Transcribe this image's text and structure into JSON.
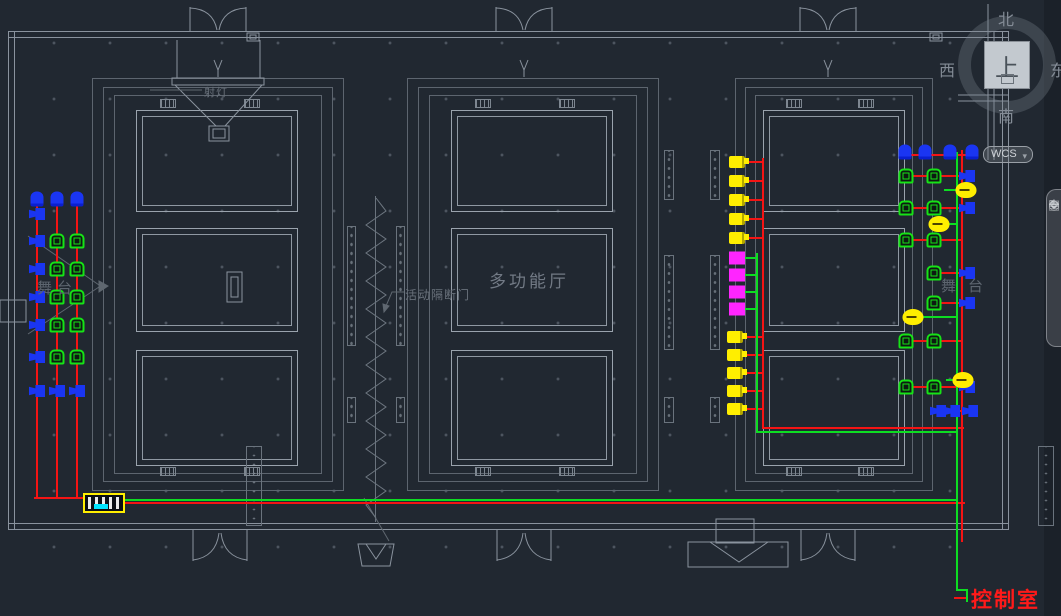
{
  "labels": {
    "stage_left": "舞台",
    "stage_right": "舞台",
    "hall": "多功能厅",
    "partition_door": "活动隔断门",
    "spotlight": "射灯",
    "control_room": "控制室"
  },
  "viewcube": {
    "north": "北",
    "south": "南",
    "west": "西",
    "east": "东",
    "top": "上",
    "wcs": "WCS",
    "dropdown_icon": "▾"
  },
  "navbar": {
    "icons": [
      {
        "name": "steering-wheel-icon",
        "glyph": "◎"
      },
      {
        "name": "pan-hand-icon",
        "glyph": "✥"
      },
      {
        "name": "zoom-icon",
        "glyph": "⌖"
      },
      {
        "name": "orbit-icon",
        "glyph": "↻"
      },
      {
        "name": "show-motion-icon",
        "glyph": "▤"
      }
    ]
  },
  "colors": {
    "background": "#212831",
    "wall": "#8a939e",
    "red": "#f41414",
    "green": "#0ddd22",
    "yellow": "#ffee00",
    "magenta": "#ff25ff",
    "blue": "#1a35f2",
    "cyan": "#00e5ff",
    "control_text": "#ff1a1a"
  },
  "wiring": {
    "segments": [
      {
        "c": "red",
        "x": 36,
        "y": 200,
        "w": 2,
        "h": 297
      },
      {
        "c": "red",
        "x": 56,
        "y": 200,
        "w": 2,
        "h": 297
      },
      {
        "c": "red",
        "x": 76,
        "y": 200,
        "w": 2,
        "h": 297
      },
      {
        "c": "red",
        "x": 34,
        "y": 497,
        "w": 52,
        "h": 2
      },
      {
        "c": "red",
        "x": 125,
        "y": 502,
        "w": 840,
        "h": 2
      },
      {
        "c": "red",
        "x": 961,
        "y": 150,
        "w": 2,
        "h": 392
      },
      {
        "c": "red",
        "x": 902,
        "y": 154,
        "w": 76,
        "h": 2
      },
      {
        "c": "red",
        "x": 762,
        "y": 158,
        "w": 2,
        "h": 271
      },
      {
        "c": "red",
        "x": 762,
        "y": 427,
        "w": 202,
        "h": 2
      },
      {
        "c": "red",
        "x": 746,
        "y": 161,
        "w": 16,
        "h": 2
      },
      {
        "c": "red",
        "x": 746,
        "y": 180,
        "w": 16,
        "h": 2
      },
      {
        "c": "red",
        "x": 746,
        "y": 199,
        "w": 16,
        "h": 2
      },
      {
        "c": "red",
        "x": 746,
        "y": 218,
        "w": 16,
        "h": 2
      },
      {
        "c": "red",
        "x": 746,
        "y": 237,
        "w": 16,
        "h": 2
      },
      {
        "c": "red",
        "x": 744,
        "y": 336,
        "w": 18,
        "h": 2
      },
      {
        "c": "red",
        "x": 744,
        "y": 354,
        "w": 18,
        "h": 2
      },
      {
        "c": "red",
        "x": 744,
        "y": 372,
        "w": 18,
        "h": 2
      },
      {
        "c": "red",
        "x": 744,
        "y": 390,
        "w": 18,
        "h": 2
      },
      {
        "c": "red",
        "x": 744,
        "y": 408,
        "w": 18,
        "h": 2
      },
      {
        "c": "red",
        "x": 913,
        "y": 175,
        "w": 48,
        "h": 2
      },
      {
        "c": "red",
        "x": 913,
        "y": 207,
        "w": 48,
        "h": 2
      },
      {
        "c": "red",
        "x": 913,
        "y": 239,
        "w": 48,
        "h": 2
      },
      {
        "c": "red",
        "x": 941,
        "y": 272,
        "w": 20,
        "h": 2
      },
      {
        "c": "red",
        "x": 941,
        "y": 302,
        "w": 20,
        "h": 2
      },
      {
        "c": "red",
        "x": 913,
        "y": 340,
        "w": 48,
        "h": 2
      },
      {
        "c": "red",
        "x": 913,
        "y": 386,
        "w": 48,
        "h": 2
      },
      {
        "c": "red",
        "x": 944,
        "y": 410,
        "w": 17,
        "h": 2
      },
      {
        "c": "red",
        "x": 954,
        "y": 597,
        "w": 12,
        "h": 2
      },
      {
        "c": "green",
        "x": 125,
        "y": 499,
        "w": 833,
        "h": 2
      },
      {
        "c": "green",
        "x": 956,
        "y": 152,
        "w": 2,
        "h": 438
      },
      {
        "c": "green",
        "x": 756,
        "y": 253,
        "w": 2,
        "h": 180
      },
      {
        "c": "green",
        "x": 756,
        "y": 431,
        "w": 202,
        "h": 2
      },
      {
        "c": "green",
        "x": 744,
        "y": 257,
        "w": 12,
        "h": 2
      },
      {
        "c": "green",
        "x": 744,
        "y": 274,
        "w": 12,
        "h": 2
      },
      {
        "c": "green",
        "x": 744,
        "y": 291,
        "w": 12,
        "h": 2
      },
      {
        "c": "green",
        "x": 744,
        "y": 308,
        "w": 12,
        "h": 2
      },
      {
        "c": "green",
        "x": 944,
        "y": 189,
        "w": 12,
        "h": 2
      },
      {
        "c": "green",
        "x": 946,
        "y": 223,
        "w": 10,
        "h": 2
      },
      {
        "c": "green",
        "x": 920,
        "y": 316,
        "w": 36,
        "h": 2
      },
      {
        "c": "green",
        "x": 946,
        "y": 379,
        "w": 10,
        "h": 2
      },
      {
        "c": "green",
        "x": 956,
        "y": 589,
        "w": 12,
        "h": 2
      },
      {
        "c": "green",
        "x": 966,
        "y": 589,
        "w": 2,
        "h": 13
      }
    ]
  },
  "devices": {
    "items": [
      {
        "t": "speaker",
        "x": 37,
        "y": 199
      },
      {
        "t": "speaker",
        "x": 57,
        "y": 199
      },
      {
        "t": "speaker",
        "x": 77,
        "y": 199
      },
      {
        "t": "horn",
        "x": 37,
        "y": 214
      },
      {
        "t": "horn",
        "x": 37,
        "y": 241
      },
      {
        "t": "horn",
        "x": 37,
        "y": 269
      },
      {
        "t": "horn",
        "x": 37,
        "y": 297
      },
      {
        "t": "horn",
        "x": 37,
        "y": 325
      },
      {
        "t": "horn",
        "x": 37,
        "y": 357
      },
      {
        "t": "horn",
        "x": 37,
        "y": 391
      },
      {
        "t": "horn",
        "x": 57,
        "y": 391
      },
      {
        "t": "horn",
        "x": 77,
        "y": 391
      },
      {
        "t": "camera",
        "x": 57,
        "y": 241
      },
      {
        "t": "camera",
        "x": 77,
        "y": 241
      },
      {
        "t": "camera",
        "x": 57,
        "y": 269
      },
      {
        "t": "camera",
        "x": 77,
        "y": 269
      },
      {
        "t": "camera",
        "x": 57,
        "y": 297
      },
      {
        "t": "camera",
        "x": 77,
        "y": 297
      },
      {
        "t": "camera",
        "x": 57,
        "y": 325
      },
      {
        "t": "camera",
        "x": 77,
        "y": 325
      },
      {
        "t": "camera",
        "x": 57,
        "y": 357
      },
      {
        "t": "camera",
        "x": 77,
        "y": 357
      },
      {
        "t": "amp",
        "x": 104,
        "y": 503
      },
      {
        "t": "spot",
        "x": 737,
        "y": 162
      },
      {
        "t": "spot",
        "x": 737,
        "y": 181
      },
      {
        "t": "spot",
        "x": 737,
        "y": 200
      },
      {
        "t": "spot",
        "x": 737,
        "y": 219
      },
      {
        "t": "spot",
        "x": 737,
        "y": 238
      },
      {
        "t": "panel",
        "x": 737,
        "y": 258
      },
      {
        "t": "panel",
        "x": 737,
        "y": 275
      },
      {
        "t": "panel",
        "x": 737,
        "y": 292
      },
      {
        "t": "panel",
        "x": 737,
        "y": 309
      },
      {
        "t": "spot",
        "x": 735,
        "y": 337
      },
      {
        "t": "spot",
        "x": 735,
        "y": 355
      },
      {
        "t": "spot",
        "x": 735,
        "y": 373
      },
      {
        "t": "spot",
        "x": 735,
        "y": 391
      },
      {
        "t": "spot",
        "x": 735,
        "y": 409
      },
      {
        "t": "speaker",
        "x": 905,
        "y": 152
      },
      {
        "t": "speaker",
        "x": 925,
        "y": 152
      },
      {
        "t": "speaker",
        "x": 950,
        "y": 152
      },
      {
        "t": "speaker",
        "x": 972,
        "y": 152
      },
      {
        "t": "camera",
        "x": 906,
        "y": 176
      },
      {
        "t": "camera",
        "x": 934,
        "y": 176
      },
      {
        "t": "camera",
        "x": 906,
        "y": 208
      },
      {
        "t": "camera",
        "x": 934,
        "y": 208
      },
      {
        "t": "camera",
        "x": 906,
        "y": 240
      },
      {
        "t": "camera",
        "x": 934,
        "y": 240
      },
      {
        "t": "camera",
        "x": 934,
        "y": 273
      },
      {
        "t": "camera",
        "x": 934,
        "y": 303
      },
      {
        "t": "camera",
        "x": 906,
        "y": 341
      },
      {
        "t": "camera",
        "x": 934,
        "y": 341
      },
      {
        "t": "camera",
        "x": 906,
        "y": 387
      },
      {
        "t": "camera",
        "x": 934,
        "y": 387
      },
      {
        "t": "horn",
        "x": 967,
        "y": 176
      },
      {
        "t": "horn",
        "x": 967,
        "y": 208
      },
      {
        "t": "horn",
        "x": 967,
        "y": 273
      },
      {
        "t": "horn",
        "x": 967,
        "y": 303
      },
      {
        "t": "horn",
        "x": 967,
        "y": 387
      },
      {
        "t": "horn",
        "x": 938,
        "y": 411
      },
      {
        "t": "horn",
        "x": 952,
        "y": 411
      },
      {
        "t": "horn",
        "x": 970,
        "y": 411
      },
      {
        "t": "lamp",
        "x": 966,
        "y": 190
      },
      {
        "t": "lamp",
        "x": 939,
        "y": 224
      },
      {
        "t": "lamp",
        "x": 913,
        "y": 317
      },
      {
        "t": "lamp",
        "x": 963,
        "y": 380
      },
      {
        "t": "wallspk",
        "x": 253,
        "y": 37
      },
      {
        "t": "wallspk",
        "x": 936,
        "y": 37
      }
    ]
  }
}
